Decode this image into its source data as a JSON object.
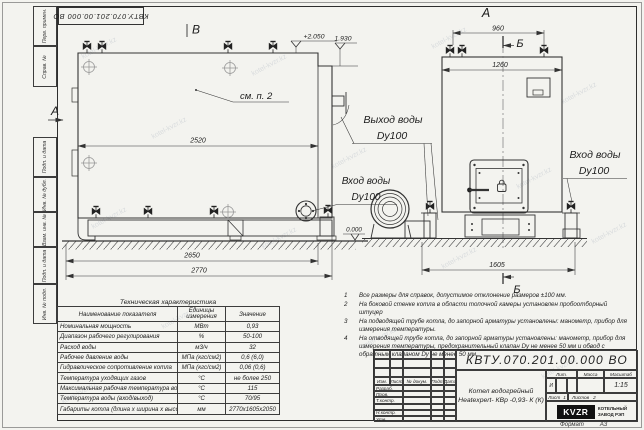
{
  "watermark": "kotel-kvzr.kz",
  "stamp": {
    "doc_number": "КВТУ.070.201.00.000  ВО"
  },
  "margin": {
    "perv_primen": "Перв. примен.",
    "sprav_no": "Справ. №",
    "podp_data1": "Подп. и дата",
    "inv_dubl": "Инв. № дубл.",
    "vzam_inv": "Взам. инв. №",
    "podp_data2": "Подп. и дата",
    "inv_podl": "Инв. № подл."
  },
  "drawing": {
    "view_b": "В",
    "section_a": "А",
    "view_a": "А",
    "section_b_top": "Б",
    "section_b_bottom": "Б",
    "see_item": "см. п. 2",
    "elev_plus2050": "+2.050",
    "elev_1930": "1.930",
    "elev_0000": "0.000",
    "dim_2520": "2520",
    "dim_2650": "2650",
    "dim_2770": "2770",
    "dim_960": "960",
    "dim_1260": "1260",
    "dim_1605": "1605",
    "water_outlet_line1": "Выход воды",
    "water_outlet_line2": "Dy100",
    "water_inlet_left_line1": "Вход воды",
    "water_inlet_left_line2": "Dy100",
    "water_inlet_right_line1": "Вход воды",
    "water_inlet_right_line2": "Dy100"
  },
  "tech_table": {
    "title": "Техническая характеристика",
    "headers": [
      "Наименование показателя",
      "Единицы измерения",
      "Значение"
    ],
    "rows": [
      [
        "Номинальная мощность",
        "МВт",
        "0,93"
      ],
      [
        "Диапазон рабочего регулирования",
        "%",
        "50-100"
      ],
      [
        "Расход воды",
        "м3/ч",
        "32"
      ],
      [
        "Рабочее давление воды",
        "МПа (кгс/см2)",
        "0,6 (6,0)"
      ],
      [
        "Гидравлическое сопротивление котла",
        "МПа (кгс/см2)",
        "0,06 (0,6)"
      ],
      [
        "Температура уходящих газов",
        "°С",
        "не более 250"
      ],
      [
        "Максимальная рабочая температура воды",
        "°С",
        "115"
      ],
      [
        "Температура воды (вход/выход)",
        "°С",
        "70/95"
      ],
      [
        "Габариты котла (длина х ширина х высота)",
        "мм",
        "2770х1605х2050"
      ]
    ]
  },
  "notes": {
    "items": [
      {
        "num": "1",
        "text": "Все размеры для справок, допустимое отклонение размеров ±100 мм."
      },
      {
        "num": "2",
        "text": "На боковой стенке котла в области топочной камеры установлен пробоотборный штуцер"
      },
      {
        "num": "3",
        "text": "На подводящей трубе котла, до запорной арматуры установлены: манометр, прибор для измерения температуры."
      },
      {
        "num": "4",
        "text": "На отводящей трубе котла, до запорной арматуры установлены: манометр, прибор для измерения температуры, предохранительный клапан Dу не менее 50 мм и обвод с обратным клапаном Dу не менее 50 мм."
      }
    ]
  },
  "title_block": {
    "doc_number": "КВТУ.070.201.00.000  ВО",
    "change_headers": [
      "Изм.",
      "Лист",
      "№ докум.",
      "Подп.",
      "Дата"
    ],
    "sign_rows": [
      "Разраб.",
      "Пров.",
      "Т.контр.",
      "",
      "Н.контр.",
      "Утв."
    ],
    "product_line1": "Котел водогрейный",
    "product_line2": "Heatexpert- КВр -0,93- К (К)",
    "lit_header": "Лит.",
    "lit_value": "И",
    "mass_header": "Масса",
    "scale_header": "Масштаб",
    "scale_value": "1:15",
    "sheet_label": "Лист",
    "sheet_value": "1",
    "sheets_label": "Листов",
    "sheets_value": "2",
    "logo_text": "KVZR",
    "company_line1": "КОТЕЛЬНЫЙ",
    "company_line2": "ЗАВОД РЭП",
    "format_label": "Формат",
    "format_value": "А3"
  }
}
